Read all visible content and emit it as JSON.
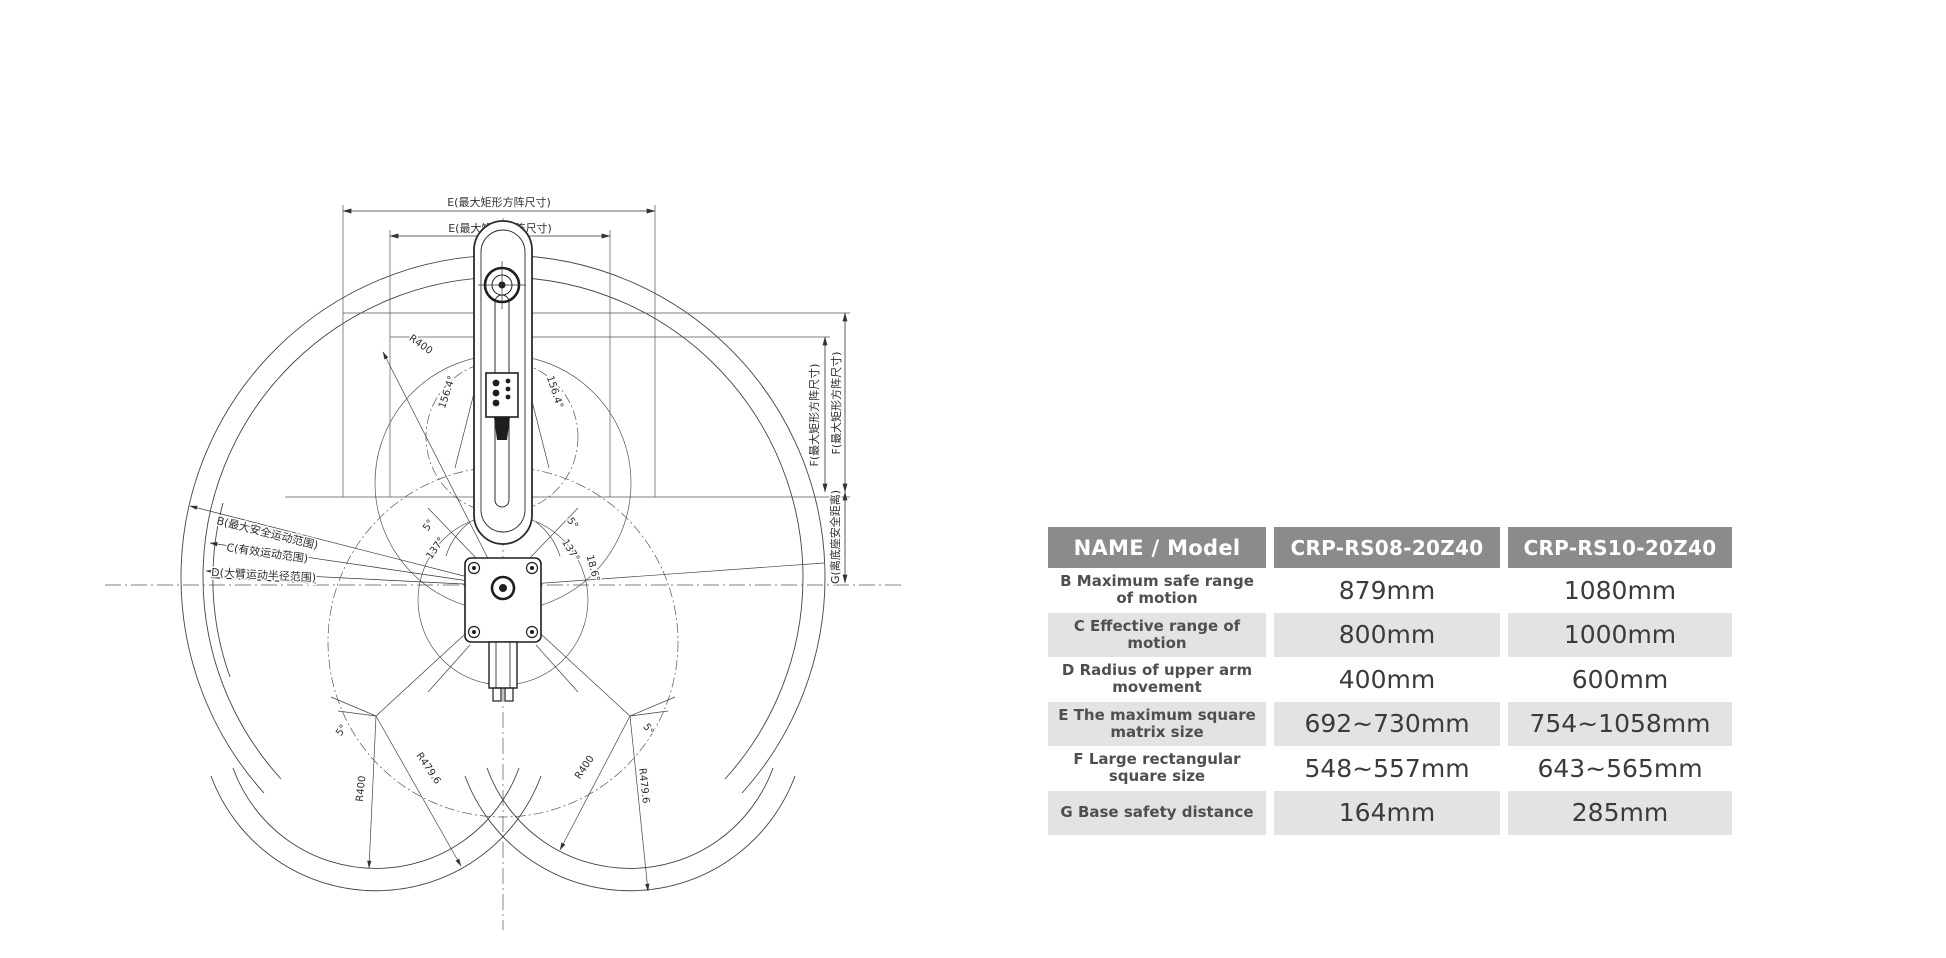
{
  "diagram": {
    "top_dims": {
      "e_outer": "E(最大矩形方阵尺寸)",
      "e_inner": "E(最大矩形方阵尺寸)"
    },
    "right_dims": {
      "f_inner": "F(最大矩形方阵尺寸)",
      "f_outer": "F(最大矩形方阵尺寸)",
      "g": "G(离底座安全距离)"
    },
    "left_leaders": {
      "b": "B(最大安全运动范围)",
      "c": "C(有效运动范围)",
      "d": "D(大臂运动半径范围)"
    },
    "center_annotations": {
      "r400": "R400",
      "left_156": "156.4°",
      "right_156": "156.4°",
      "a23": "23.6°",
      "left_5": "5°",
      "left_137": "137°",
      "right_5": "5°",
      "right_137": "137°",
      "a18": "18.6°"
    },
    "bottom_annotations": {
      "left_5": "5°",
      "left_r400": "R400",
      "left_r479": "R479.6",
      "right_5": "5°",
      "right_r400": "R400",
      "right_r479": "R479.6"
    }
  },
  "table": {
    "headers": [
      "NAME / Model",
      "CRP-RS08-20Z40",
      "CRP-RS10-20Z40"
    ],
    "rows": [
      {
        "name": "B Maximum safe range of motion",
        "v1": "879mm",
        "v2": "1080mm"
      },
      {
        "name": "C Effective range of motion",
        "v1": "800mm",
        "v2": "1000mm"
      },
      {
        "name": "D Radius of upper arm movement",
        "v1": "400mm",
        "v2": "600mm"
      },
      {
        "name": "E The maximum square matrix size",
        "v1": "692~730mm",
        "v2": "754~1058mm"
      },
      {
        "name": "F Large rectangular square size",
        "v1": "548~557mm",
        "v2": "643~565mm"
      },
      {
        "name": "G Base safety distance",
        "v1": "164mm",
        "v2": "285mm"
      }
    ],
    "colors": {
      "header_bg": "#8b8b8b",
      "header_text": "#ffffff",
      "row_alt_bg": "#e3e3e3",
      "value_text": "#3b3b3b"
    }
  }
}
